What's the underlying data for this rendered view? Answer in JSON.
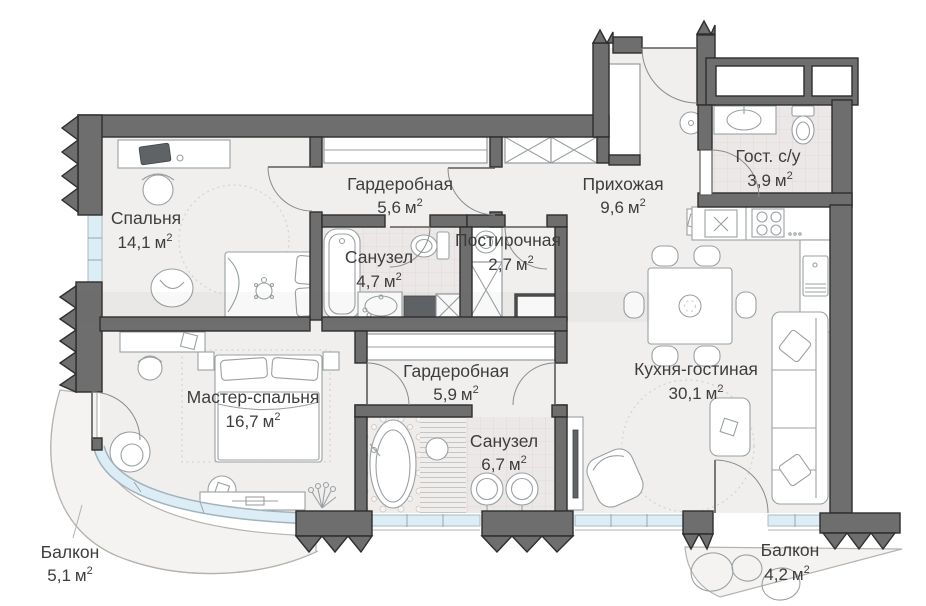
{
  "plan": {
    "area_unit": "м",
    "area_sup": "2",
    "rooms": [
      {
        "name": "Спальня",
        "area_value": "14,1"
      },
      {
        "name": "Гардеробная",
        "area_value": "5,6"
      },
      {
        "name": "Прихожая",
        "area_value": "9,6"
      },
      {
        "name": "Гост. с/у",
        "area_value": "3,9"
      },
      {
        "name": "Санузел",
        "area_value": "4,7"
      },
      {
        "name": "Постирочная",
        "area_value": "2,7"
      },
      {
        "name": "Мастер-спальня",
        "area_value": "16,7"
      },
      {
        "name": "Гардеробная",
        "area_value": "5,9"
      },
      {
        "name": "Санузел",
        "area_value": "6,7"
      },
      {
        "name": "Кухня-гостиная",
        "area_value": "30,1"
      },
      {
        "name": "Балкон",
        "area_value": "5,1"
      },
      {
        "name": "Балкон",
        "area_value": "4,2"
      }
    ],
    "colors": {
      "wall": "#6e6e6e",
      "wall_outline": "#2e2e2e",
      "window_glazing": "#dcedf6",
      "floor": "#f1efed",
      "tile": "#ece8e7",
      "label_text": "#3d3d3d",
      "furniture_line": "#9aa0a3"
    }
  }
}
